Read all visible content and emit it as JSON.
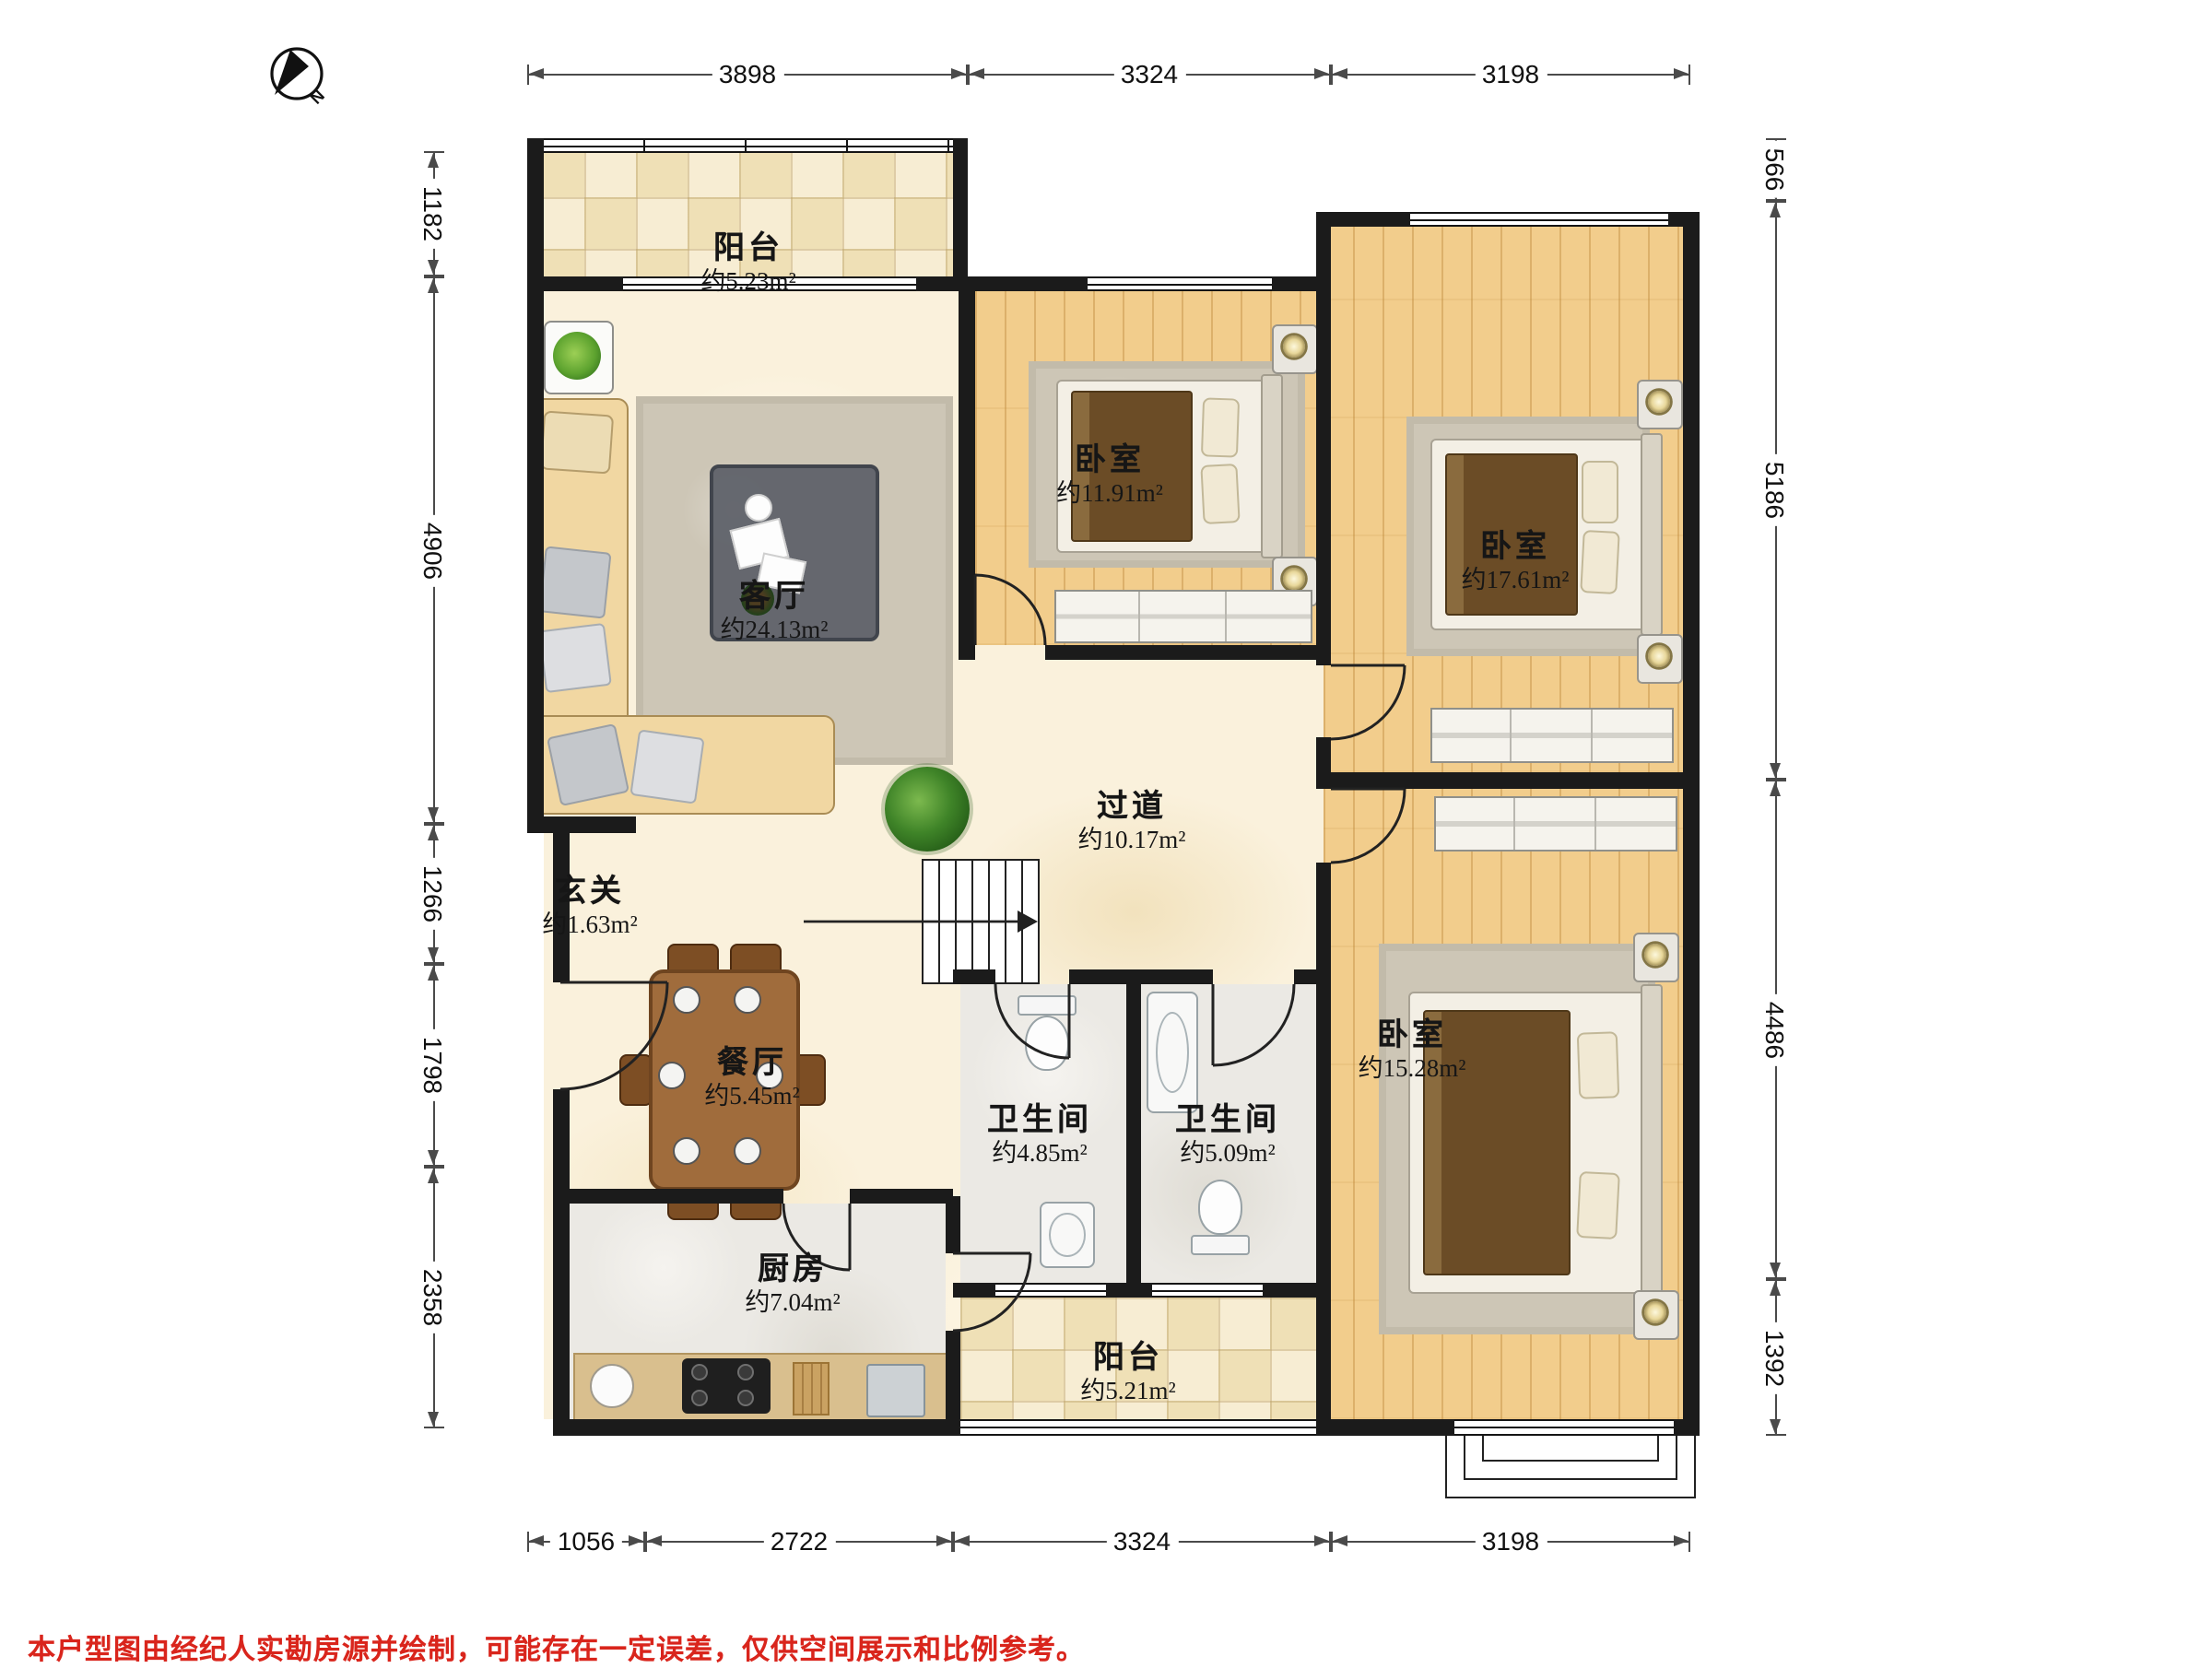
{
  "compass": {
    "label": "N"
  },
  "rooms": {
    "balcony_top": {
      "name": "阳台",
      "area": "约5.23m²"
    },
    "living": {
      "name": "客厅",
      "area": "约24.13m²"
    },
    "bedroom_mid": {
      "name": "卧室",
      "area": "约11.91m²"
    },
    "bedroom_top_right": {
      "name": "卧室",
      "area": "约17.61m²"
    },
    "hallway": {
      "name": "过道",
      "area": "约10.17m²"
    },
    "entry": {
      "name": "玄关",
      "area": "约1.63m²"
    },
    "dining": {
      "name": "餐厅",
      "area": "约5.45m²"
    },
    "bath_1": {
      "name": "卫生间",
      "area": "约4.85m²"
    },
    "bath_2": {
      "name": "卫生间",
      "area": "约5.09m²"
    },
    "bedroom_bot_right": {
      "name": "卧室",
      "area": "约15.28m²"
    },
    "kitchen": {
      "name": "厨房",
      "area": "约7.04m²"
    },
    "balcony_bottom": {
      "name": "阳台",
      "area": "约5.21m²"
    }
  },
  "dimensions": {
    "top": [
      "3898",
      "3324",
      "3198"
    ],
    "bottom": [
      "1056",
      "2722",
      "3324",
      "3198"
    ],
    "left": [
      "1182",
      "4906",
      "1266",
      "1798",
      "2358"
    ],
    "right": [
      "566",
      "5186",
      "4486",
      "1392"
    ]
  },
  "disclaimer": "本户型图由经纪人实勘房源并绘制，可能存在一定误差，仅供空间展示和比例参考。",
  "colors": {
    "wall": "#1b1b1b",
    "wood": "#f2cd8c",
    "tile": "#f6ecd2",
    "marble": "#faf1dc",
    "stone": "#ebe9e4",
    "disclaimer_red": "#d9251c"
  }
}
